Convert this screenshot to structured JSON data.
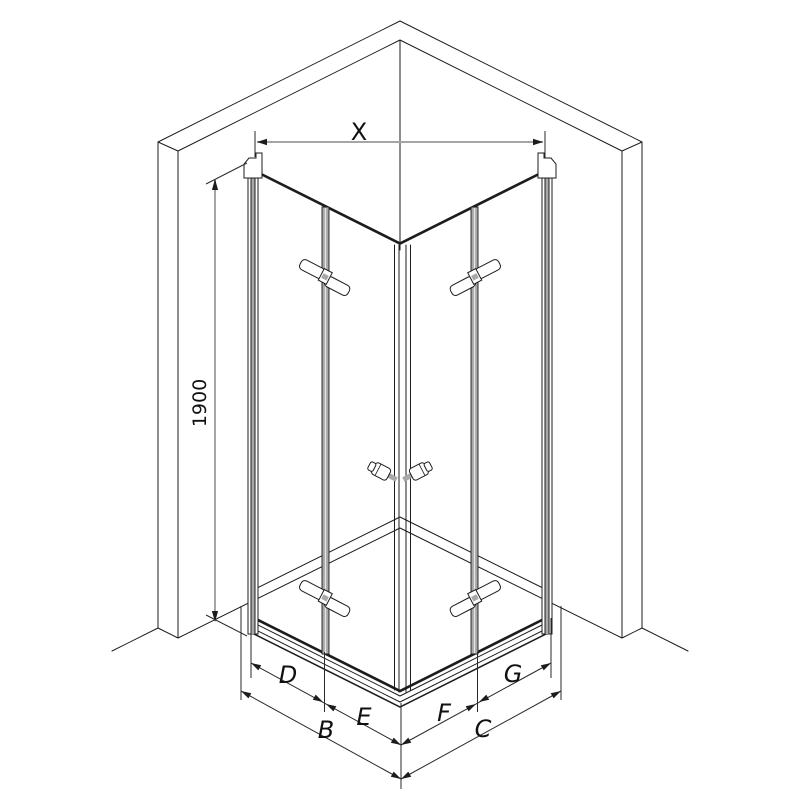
{
  "diagram": {
    "type": "isometric-technical-drawing",
    "subject": "corner shower enclosure with two bi-fold doors and side walls",
    "labels": {
      "width_top": "X",
      "height_side": "1900",
      "left_door_outer": "D",
      "left_door_inner": "E",
      "right_door_inner": "F",
      "right_door_outer": "G",
      "left_side_total": "B",
      "right_side_total": "C"
    },
    "colors": {
      "line": "#1c1c1c",
      "dimension_line_gray": "#a5a5a5",
      "profile_gray": "#a8a8a8",
      "background": "#ffffff",
      "label_text": "#111111"
    }
  }
}
